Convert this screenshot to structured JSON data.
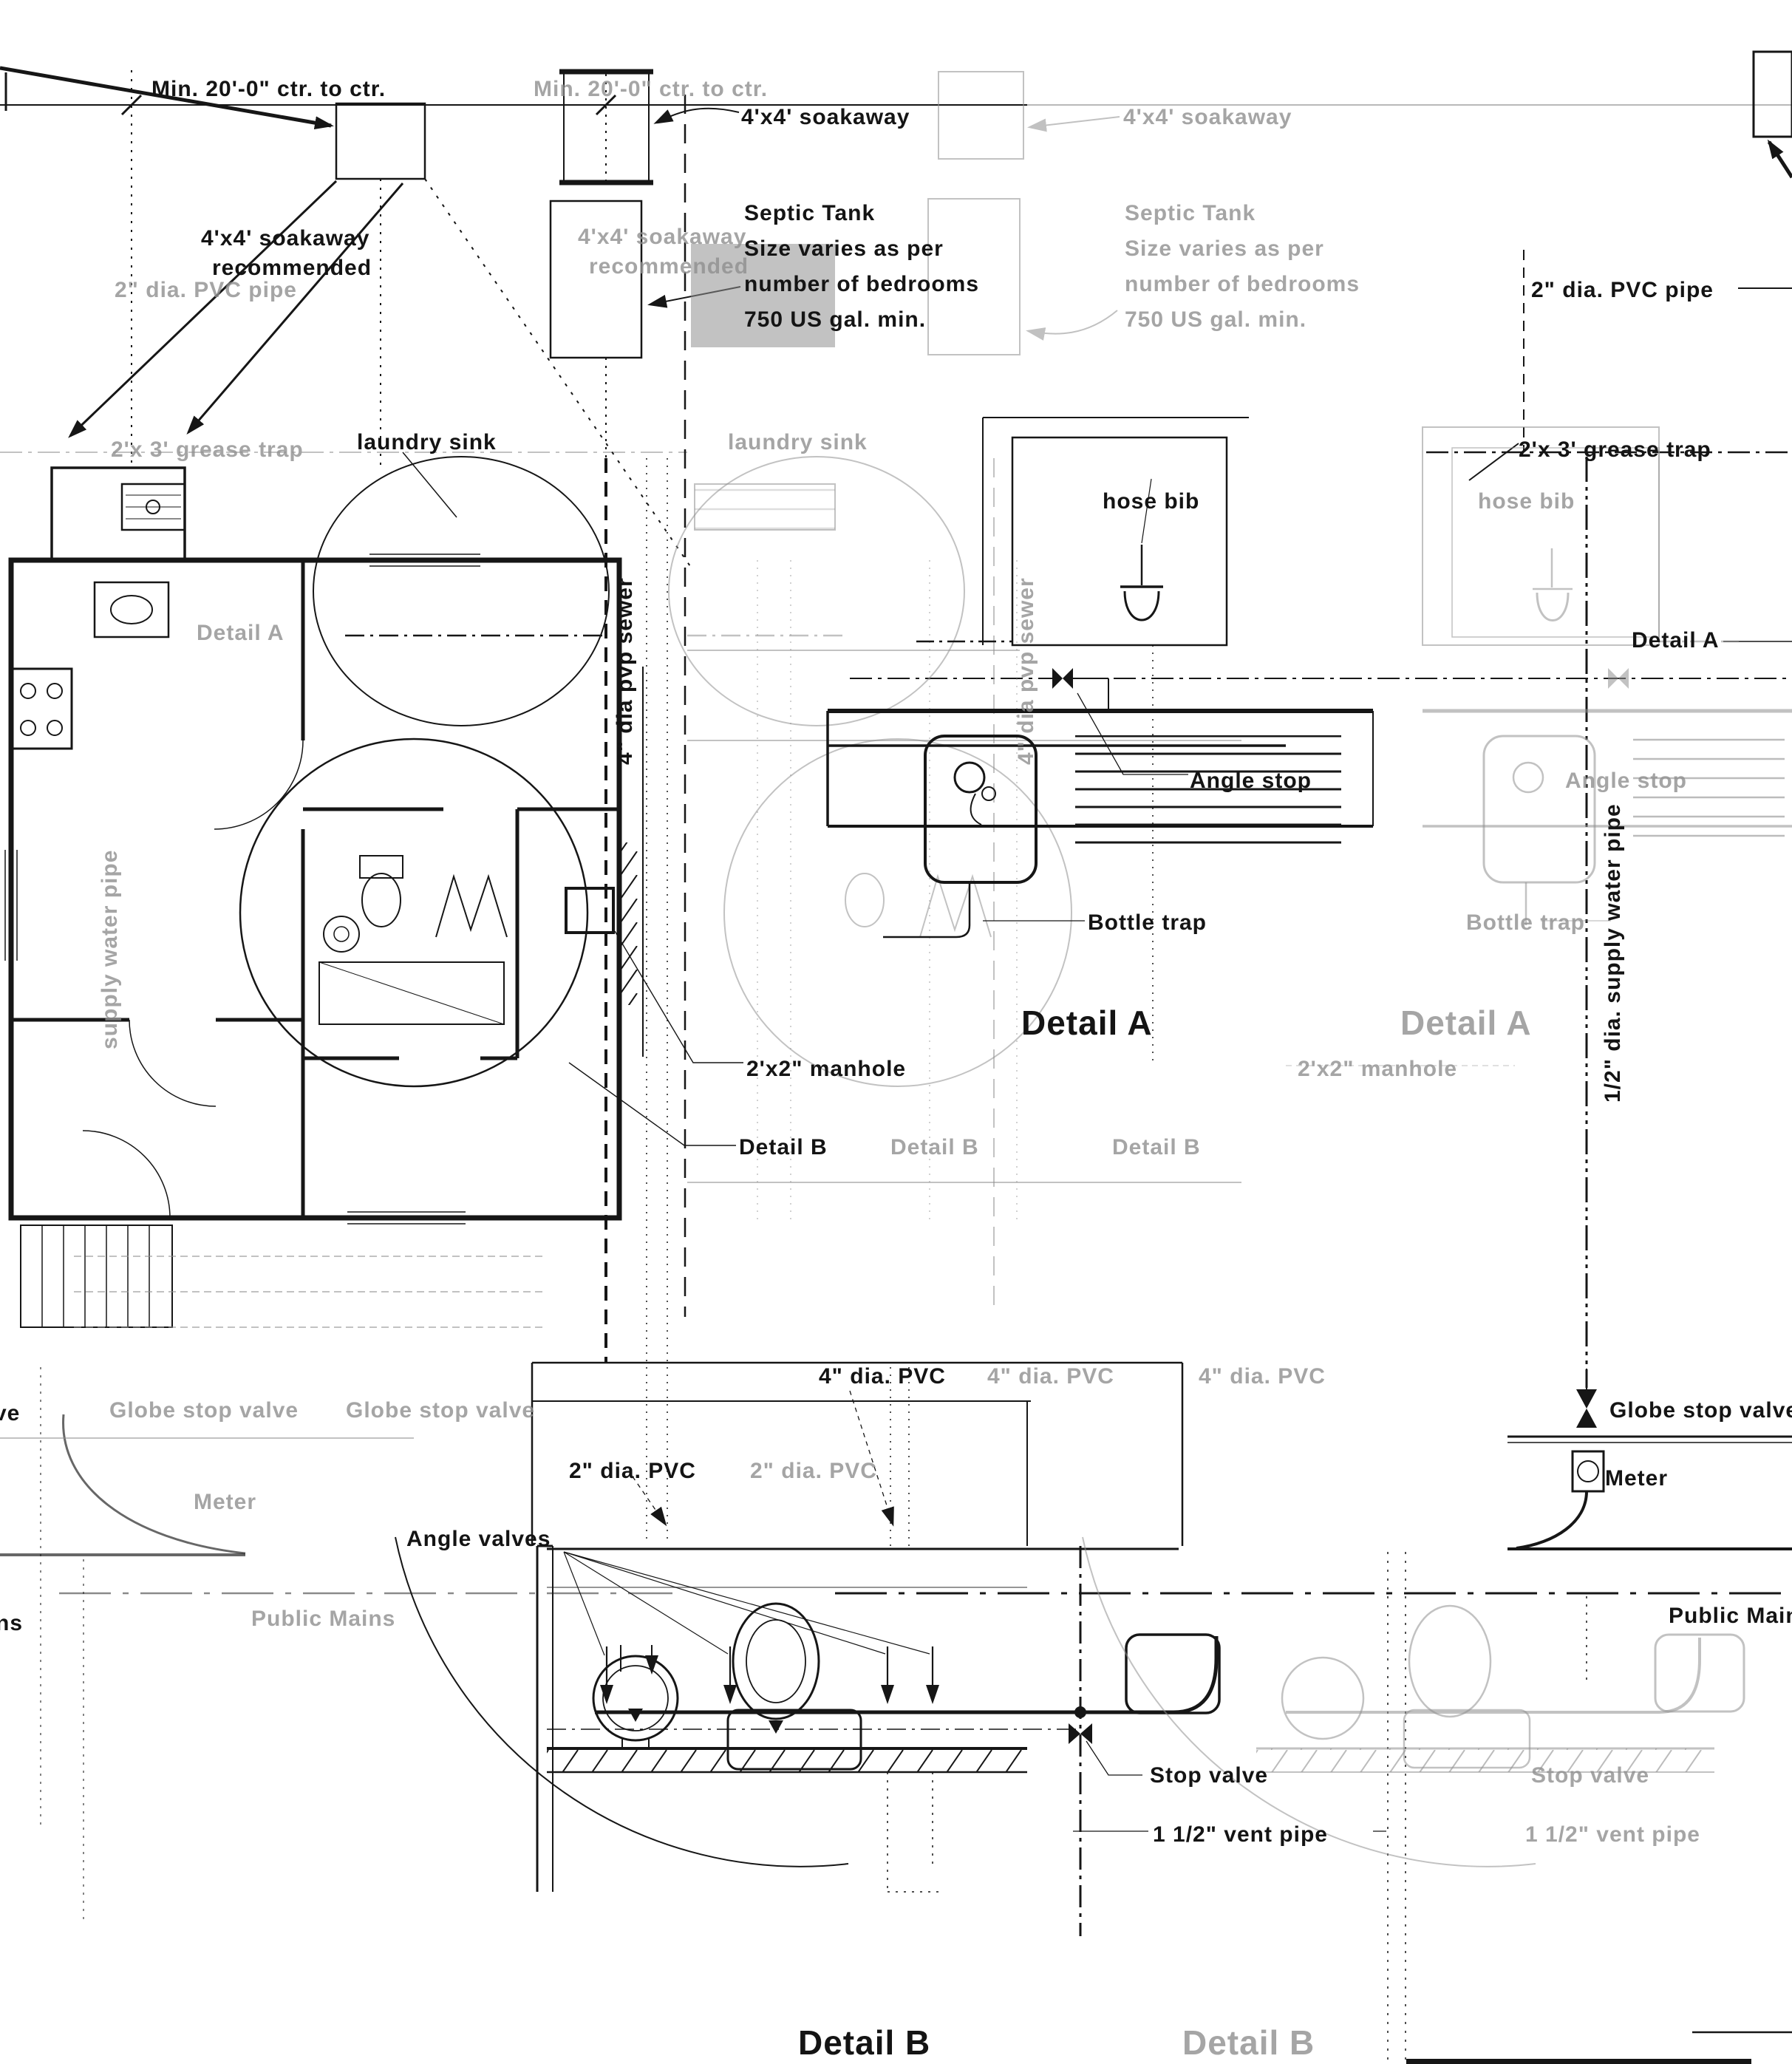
{
  "colors": {
    "ink": "#161616",
    "ghost": "#8f8f8f",
    "paper": "#ffffff"
  },
  "labels": {
    "min_ctr": "Min. 20'-0\" ctr. to ctr.",
    "soakaway": "4'x4' soakaway",
    "recommended": "recommended",
    "septic_line1": "Septic Tank",
    "septic_line2": "Size varies as per",
    "septic_line3": "number of bedrooms",
    "septic_line4": "750 US gal. min.",
    "pvc_pipe_2in": "2\" dia. PVC pipe",
    "grease_trap": "2'x 3' grease trap",
    "laundry_sink": "laundry sink",
    "hose_bib": "hose bib",
    "angle_stop": "Angle stop",
    "bottle_trap": "Bottle trap",
    "detail_a": "Detail A",
    "detail_b": "Detail B",
    "manhole": "2'x2\" manhole",
    "sewer_pipe": "4\" dia pvp sewer",
    "supply_pipe": "1/2\" dia. supply water pipe",
    "supply_pipe_short": "supply water pipe",
    "pvc_4": "4\" dia. PVC",
    "pvc_2": "2\" dia. PVC",
    "angle_valves": "Angle valves",
    "globe_stop_valve": "Globe stop valve",
    "meter": "Meter",
    "public_mains": "Public Mains",
    "stop_valve": "Stop valve",
    "vent_pipe": "1 1/2\" vent pipe",
    "frag_ve": "ve",
    "frag_ns": "ns"
  }
}
